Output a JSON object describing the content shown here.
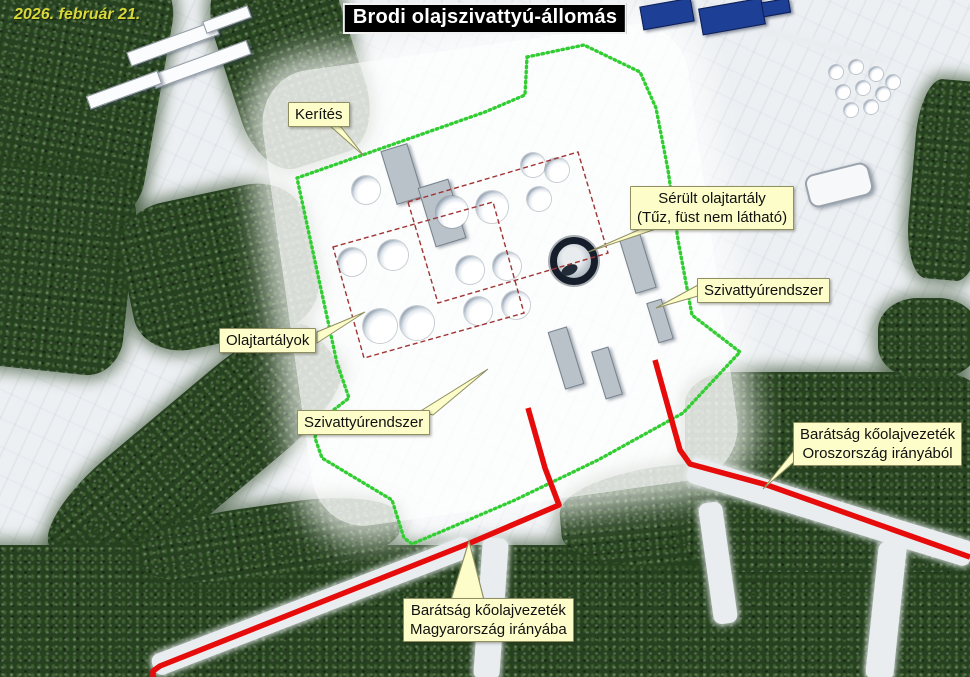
{
  "scene": {
    "date_label": "2026. február 21.",
    "title": "Brodi olajszivattyú-állomás"
  },
  "labels": {
    "fence": {
      "text": "Kerítés"
    },
    "damaged_tank": {
      "line1": "Sérült olajtartály",
      "line2": "(Tűz, füst nem látható)"
    },
    "pump_system_right": {
      "text": "Szivattyúrendszer"
    },
    "oil_tanks": {
      "text": "Olajtartályok"
    },
    "pump_system_left": {
      "text": "Szivattyúrendszer"
    },
    "pipeline_from_russia": {
      "line1": "Barátság kőolajvezeték",
      "line2": "Oroszország irányából"
    },
    "pipeline_to_hungary": {
      "line1": "Barátság kőolajvezeték",
      "line2": "Magyarország irányába"
    }
  },
  "colors": {
    "annotation_bg": "#fdfdc9",
    "annotation_border": "#8f8f62",
    "fence_green": "#32cd32",
    "pipeline_red": "#e60c0c",
    "tank_outline_red": "#a03434",
    "date_yellow": "#d8d838",
    "title_bg": "#000000",
    "title_fg": "#ffffff"
  },
  "overlay": {
    "boundary": "527,57 584,45 640,72 656,108 668,170 678,240 692,315 740,352 683,413 598,460 515,500 452,527 412,544 404,538 392,500 322,458 315,438 318,422 349,398 337,363 297,178 485,112 525,95 527,57",
    "pipeline_to_hungary": "528,408 545,468 559,505 470,543 160,666 153,671 153,677",
    "pipeline_from_russia": "655,360 680,450 690,464 767,485 970,557",
    "tank_outline_a": "408,202 578,152 608,253 438,303",
    "tank_outline_b": "333,247 493,202 524,313 364,358",
    "arrow_to_pipeline": "469,541 451,600 484,600",
    "leader_fence": "329,125 341,127 364,156",
    "leader_damaged_tank": "643,228 659,228 588,252",
    "leader_pump_right": "698,285 698,296 656,308",
    "leader_oil_tanks": "317,332 317,343 365,312",
    "leader_pump_left": "419,412 433,415 488,369",
    "leader_pipeline_russia": "795,449 795,461 763,489"
  },
  "map": {
    "tanks": [
      {
        "x": 366,
        "y": 190,
        "r": 14
      },
      {
        "x": 452,
        "y": 212,
        "r": 16
      },
      {
        "x": 492,
        "y": 207,
        "r": 16
      },
      {
        "x": 352,
        "y": 262,
        "r": 14
      },
      {
        "x": 393,
        "y": 255,
        "r": 15
      },
      {
        "x": 470,
        "y": 270,
        "r": 14
      },
      {
        "x": 507,
        "y": 266,
        "r": 14
      },
      {
        "x": 478,
        "y": 311,
        "r": 14
      },
      {
        "x": 516,
        "y": 305,
        "r": 14
      },
      {
        "x": 533,
        "y": 165,
        "r": 12
      },
      {
        "x": 557,
        "y": 170,
        "r": 12
      },
      {
        "x": 539,
        "y": 199,
        "r": 12
      },
      {
        "x": 380,
        "y": 326,
        "r": 17
      },
      {
        "x": 417,
        "y": 323,
        "r": 17
      }
    ],
    "small_tanks": [
      {
        "x": 836,
        "y": 72
      },
      {
        "x": 856,
        "y": 67
      },
      {
        "x": 876,
        "y": 74
      },
      {
        "x": 843,
        "y": 92
      },
      {
        "x": 863,
        "y": 88
      },
      {
        "x": 883,
        "y": 94
      },
      {
        "x": 851,
        "y": 110
      },
      {
        "x": 871,
        "y": 107
      },
      {
        "x": 893,
        "y": 82
      }
    ],
    "small_tank_radius": 7,
    "damaged_tank": {
      "x": 574,
      "y": 261,
      "r": 24
    },
    "forests": [
      {
        "x": -40,
        "y": -40,
        "w": 200,
        "h": 250,
        "rot": 10,
        "br": "18%"
      },
      {
        "x": 225,
        "y": -45,
        "w": 130,
        "h": 210,
        "rot": -18,
        "br": "30%"
      },
      {
        "x": -45,
        "y": 170,
        "w": 175,
        "h": 200,
        "rot": 6,
        "br": "20%"
      },
      {
        "x": 125,
        "y": 192,
        "w": 188,
        "h": 150,
        "rot": -12,
        "br": "28%"
      },
      {
        "x": 25,
        "y": 400,
        "w": 340,
        "h": 110,
        "rot": -40,
        "br": "30%"
      },
      {
        "x": -20,
        "y": 545,
        "w": 1010,
        "h": 150,
        "rot": 0,
        "br": "0"
      },
      {
        "x": 140,
        "y": 505,
        "w": 260,
        "h": 70,
        "rot": -8,
        "br": "40%"
      },
      {
        "x": 560,
        "y": 462,
        "w": 300,
        "h": 100,
        "rot": -5,
        "br": "40%"
      },
      {
        "x": 685,
        "y": 372,
        "w": 300,
        "h": 200,
        "rot": 0,
        "br": "16%"
      },
      {
        "x": 912,
        "y": 80,
        "w": 75,
        "h": 200,
        "rot": 5,
        "br": "30%"
      },
      {
        "x": 878,
        "y": 298,
        "w": 100,
        "h": 80,
        "rot": 0,
        "br": "40%"
      }
    ],
    "corridors": [
      {
        "x": 682,
        "y": 499,
        "w": 296,
        "h": 26,
        "rot": 17
      },
      {
        "x": 142,
        "y": 595,
        "w": 340,
        "h": 22,
        "rot": -21
      },
      {
        "x": 478,
        "y": 538,
        "w": 26,
        "h": 142,
        "rot": 4
      },
      {
        "x": 706,
        "y": 502,
        "w": 24,
        "h": 122,
        "rot": -8
      },
      {
        "x": 872,
        "y": 542,
        "w": 28,
        "h": 138,
        "rot": 6
      },
      {
        "x": 640,
        "y": 28,
        "w": 250,
        "h": 6,
        "rot": 14
      }
    ],
    "buildings": [
      {
        "x": 126,
        "y": 36,
        "w": 92,
        "h": 13,
        "rot": -20,
        "t": "white"
      },
      {
        "x": 150,
        "y": 57,
        "w": 100,
        "h": 13,
        "rot": -20,
        "t": "white"
      },
      {
        "x": 86,
        "y": 83,
        "w": 74,
        "h": 12,
        "rot": -20,
        "t": "white"
      },
      {
        "x": 203,
        "y": 13,
        "w": 46,
        "h": 11,
        "rot": -20,
        "t": "white"
      },
      {
        "x": 641,
        "y": 2,
        "w": 50,
        "h": 22,
        "rot": -10,
        "t": "blue"
      },
      {
        "x": 700,
        "y": 3,
        "w": 62,
        "h": 25,
        "rot": -10,
        "t": "blue"
      },
      {
        "x": 762,
        "y": 0,
        "w": 26,
        "h": 13,
        "rot": -10,
        "t": "blue"
      },
      {
        "x": 806,
        "y": 168,
        "w": 62,
        "h": 30,
        "rot": -14,
        "t": "hangar"
      },
      {
        "x": 388,
        "y": 146,
        "w": 26,
        "h": 54,
        "rot": -17,
        "t": "gray"
      },
      {
        "x": 426,
        "y": 182,
        "w": 30,
        "h": 60,
        "rot": -17,
        "t": "gray"
      },
      {
        "x": 627,
        "y": 236,
        "w": 20,
        "h": 54,
        "rot": -17,
        "t": "gray"
      },
      {
        "x": 556,
        "y": 328,
        "w": 18,
        "h": 58,
        "rot": -17,
        "t": "gray"
      },
      {
        "x": 598,
        "y": 348,
        "w": 16,
        "h": 48,
        "rot": -17,
        "t": "gray"
      },
      {
        "x": 652,
        "y": 300,
        "w": 14,
        "h": 40,
        "rot": -17,
        "t": "gray"
      }
    ]
  }
}
